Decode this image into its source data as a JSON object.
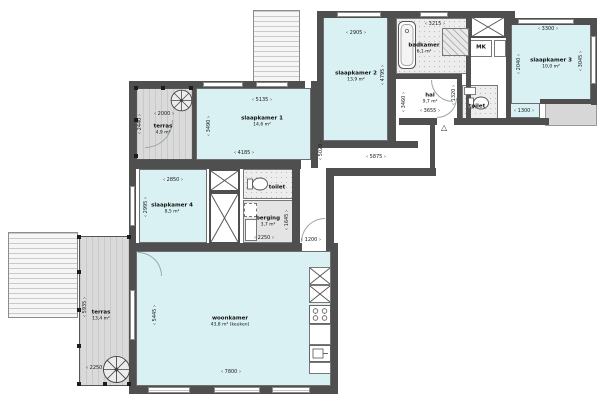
{
  "rooms": {
    "terras_top": {
      "name": "terras",
      "area": "4,9 m²"
    },
    "slaapkamer1": {
      "name": "slaapkamer 1",
      "area": "14,6 m²"
    },
    "slaapkamer2": {
      "name": "slaapkamer 2",
      "area": "13,9 m²"
    },
    "badkamer": {
      "name": "badkamer",
      "area": "6,1 m²"
    },
    "mk": {
      "name": "MK"
    },
    "slaapkamer3": {
      "name": "slaapkamer 3",
      "area": "10,0 m²"
    },
    "toilet_top": {
      "name": "toilet"
    },
    "hal": {
      "name": "hal",
      "area": "9,7 m²"
    },
    "slaapkamer4": {
      "name": "slaapkamer 4",
      "area": "8,5 m²"
    },
    "toilet_mid": {
      "name": "toilet"
    },
    "berging": {
      "name": "berging",
      "area": "3,7 m²"
    },
    "woonkamer": {
      "name": "woonkamer",
      "area": "43,8 m² (keuken)"
    },
    "terras_bottom": {
      "name": "terras",
      "area": "13,4 m²"
    }
  },
  "dims": [
    {
      "label": "2000"
    },
    {
      "label": "2440"
    },
    {
      "label": "5135"
    },
    {
      "label": "3490"
    },
    {
      "label": "4185"
    },
    {
      "label": "2905"
    },
    {
      "label": "4795"
    },
    {
      "label": "3215"
    },
    {
      "label": "1910"
    },
    {
      "label": "3300"
    },
    {
      "label": "2040"
    },
    {
      "label": "3045"
    },
    {
      "label": "1320"
    },
    {
      "label": "3655"
    },
    {
      "label": "3460"
    },
    {
      "label": "5020"
    },
    {
      "label": "5875"
    },
    {
      "label": "1200"
    },
    {
      "label": "2850"
    },
    {
      "label": "2995"
    },
    {
      "label": "2250"
    },
    {
      "label": "1645"
    },
    {
      "label": "1300"
    },
    {
      "label": "7800"
    },
    {
      "label": "5445"
    },
    {
      "label": "5935"
    },
    {
      "label": "2250"
    }
  ],
  "markers": {
    "entrance_triangle": "△"
  },
  "colors": {
    "room_fill": "#d9f1f3",
    "wall": "#4f4f4f",
    "terrace_fill": "#dadada"
  }
}
